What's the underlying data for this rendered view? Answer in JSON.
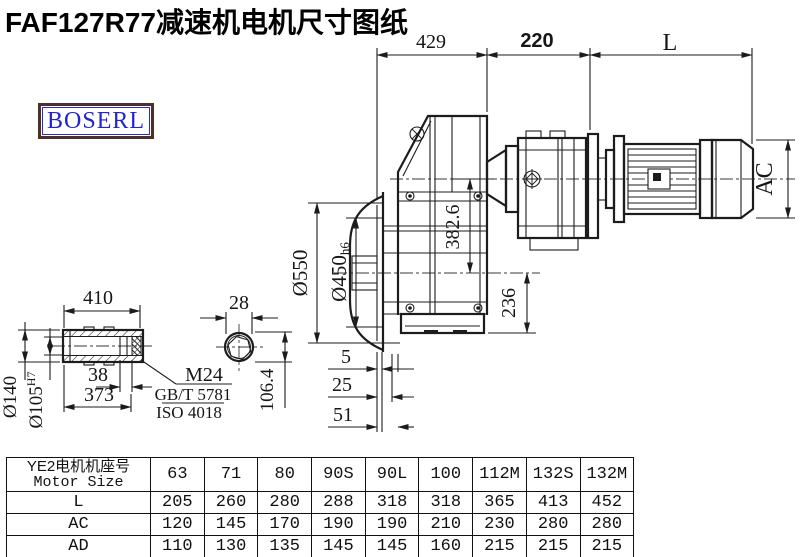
{
  "title": "FAF127R77减速机电机尺寸图纸",
  "logo": "BOSERL",
  "drawing": {
    "dims": {
      "top_429": "429",
      "top_220": "220",
      "top_L": "L",
      "ac": "AC",
      "v382": "382.6",
      "v236": "236",
      "d550": "Ø550",
      "d450": "Ø450",
      "d450_suffix": "h6",
      "b5": "5",
      "b25": "25",
      "b51": "51"
    },
    "shaft": {
      "len410": "410",
      "w38": "38",
      "len373": "373",
      "d140": "Ø140",
      "d105": "Ø105",
      "d105_sup": "H7",
      "w28": "28",
      "h106": "106.4",
      "note_m24": "M24",
      "note_gbt": "GB/T 5781",
      "note_iso": "ISO 4018"
    }
  },
  "table": {
    "header_cn": "YE2电机机座号",
    "header_en": "Motor Size",
    "columns": [
      "63",
      "71",
      "80",
      "90S",
      "90L",
      "100",
      "112M",
      "132S",
      "132M"
    ],
    "rows": [
      {
        "label": "L",
        "values": [
          "205",
          "260",
          "280",
          "288",
          "318",
          "318",
          "365",
          "413",
          "452"
        ]
      },
      {
        "label": "AC",
        "values": [
          "120",
          "145",
          "170",
          "190",
          "190",
          "210",
          "230",
          "280",
          "280"
        ]
      },
      {
        "label": "AD",
        "values": [
          "110",
          "130",
          "135",
          "145",
          "145",
          "160",
          "215",
          "215",
          "215"
        ]
      }
    ]
  }
}
